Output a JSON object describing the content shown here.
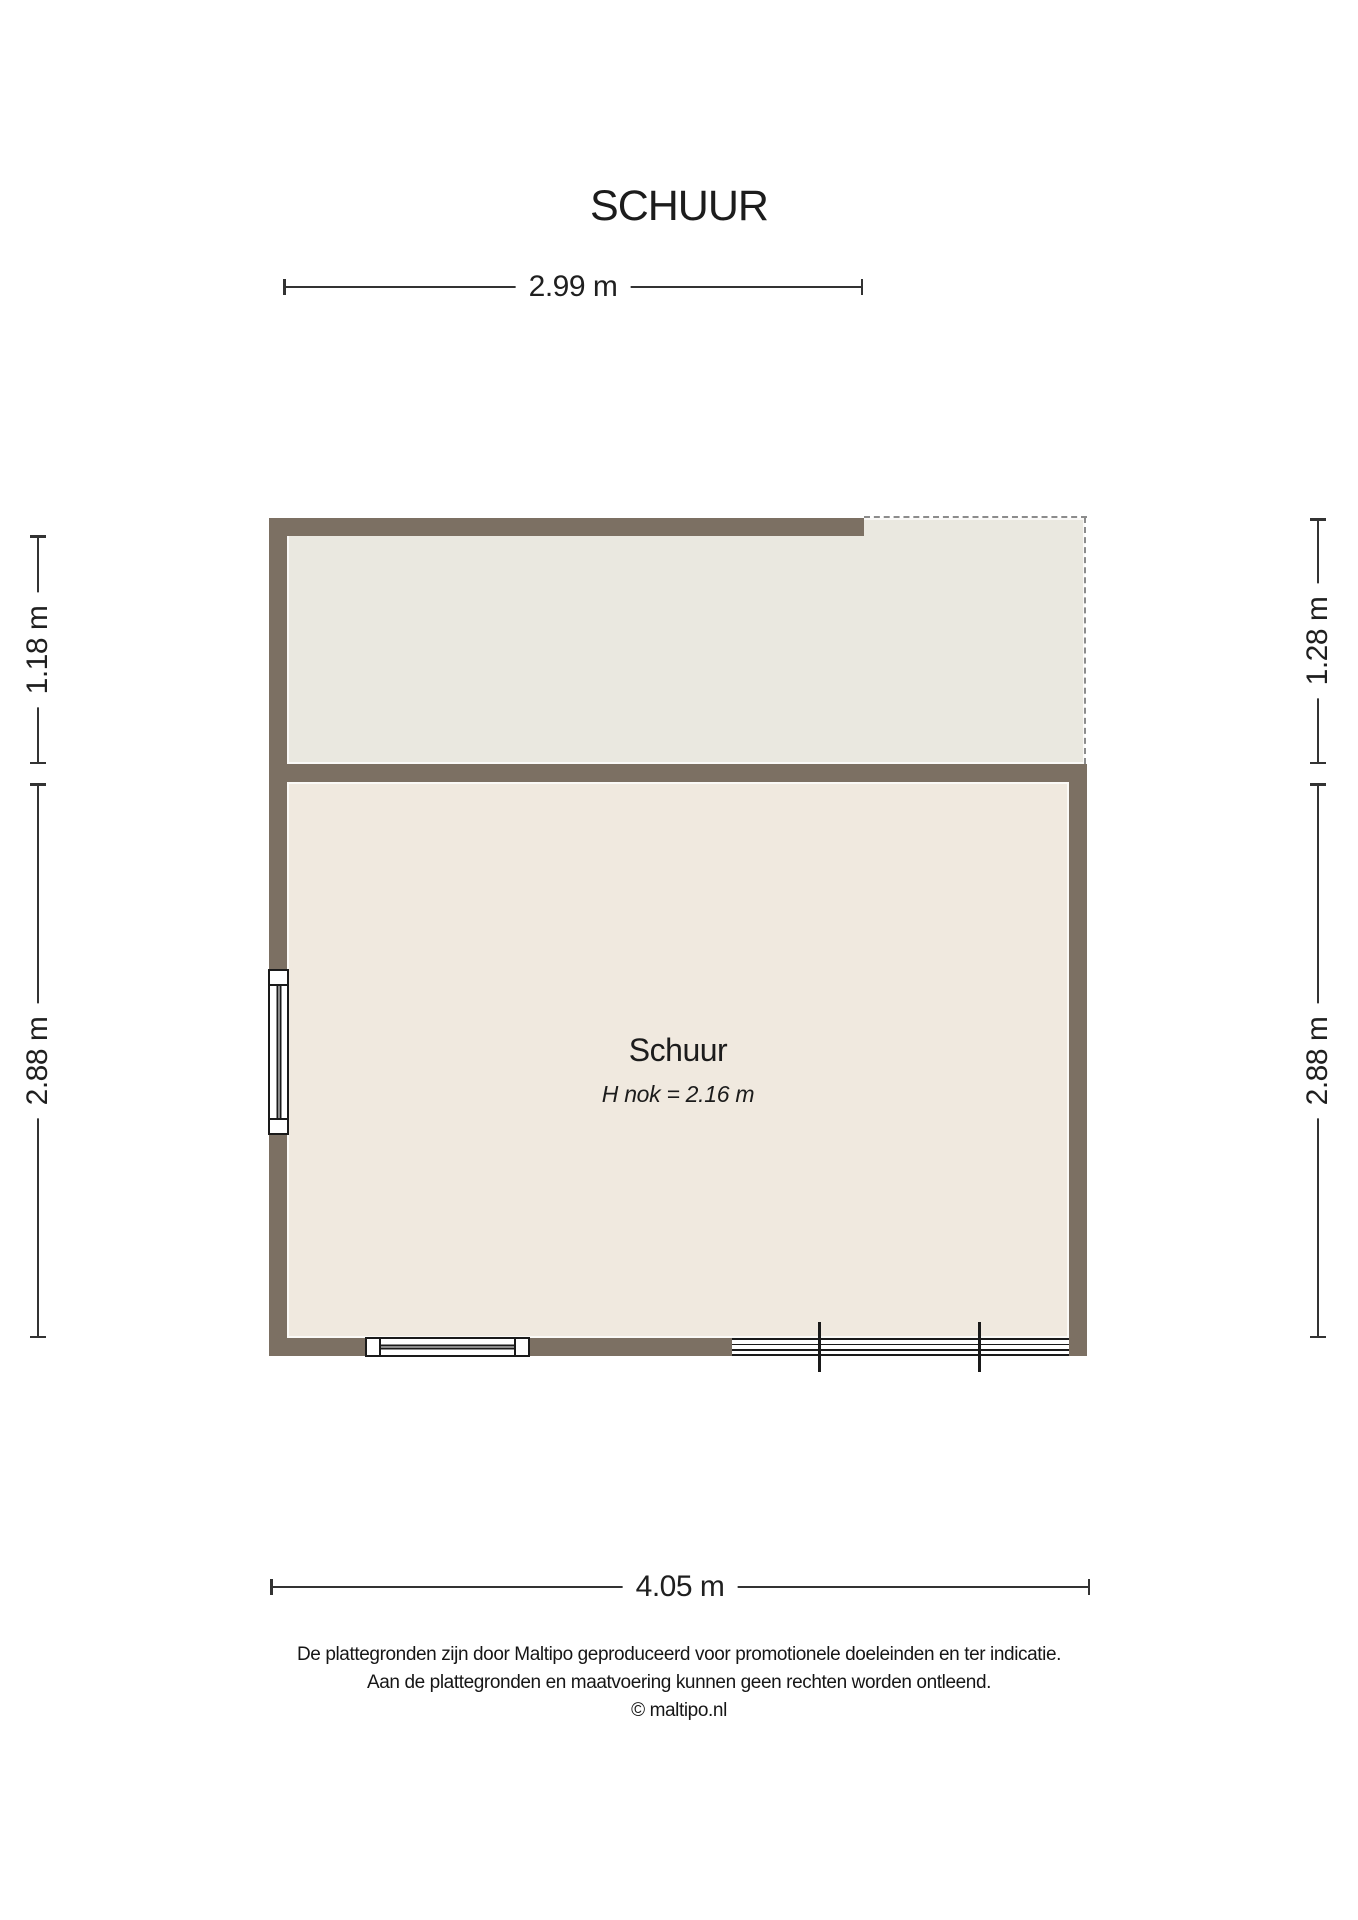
{
  "title": "SCHUUR",
  "plan": {
    "room_label": "Schuur",
    "room_sublabel": "H nok = 2.16 m",
    "colors": {
      "ink": "#1c1c1c",
      "wall": "#7c7063",
      "upper_room_fill": "#eae8e0",
      "lower_room_fill": "#f0e9df",
      "dashed_line": "#8c8c8c",
      "dimension_line": "#333333",
      "window_stroke": "#1a1a1a"
    }
  },
  "dimensions": {
    "top": "2.99 m",
    "bottom": "4.05 m",
    "left_upper": "1.18 m",
    "left_lower": "2.88 m",
    "right_upper": "1.28 m",
    "right_lower": "2.88 m"
  },
  "footer": {
    "line1": "De plattegronden zijn door Maltipo geproduceerd voor promotionele doeleinden en ter indicatie.",
    "line2": "Aan de plattegronden en maatvoering kunnen geen rechten worden ontleend.",
    "line3": "© maltipo.nl"
  }
}
